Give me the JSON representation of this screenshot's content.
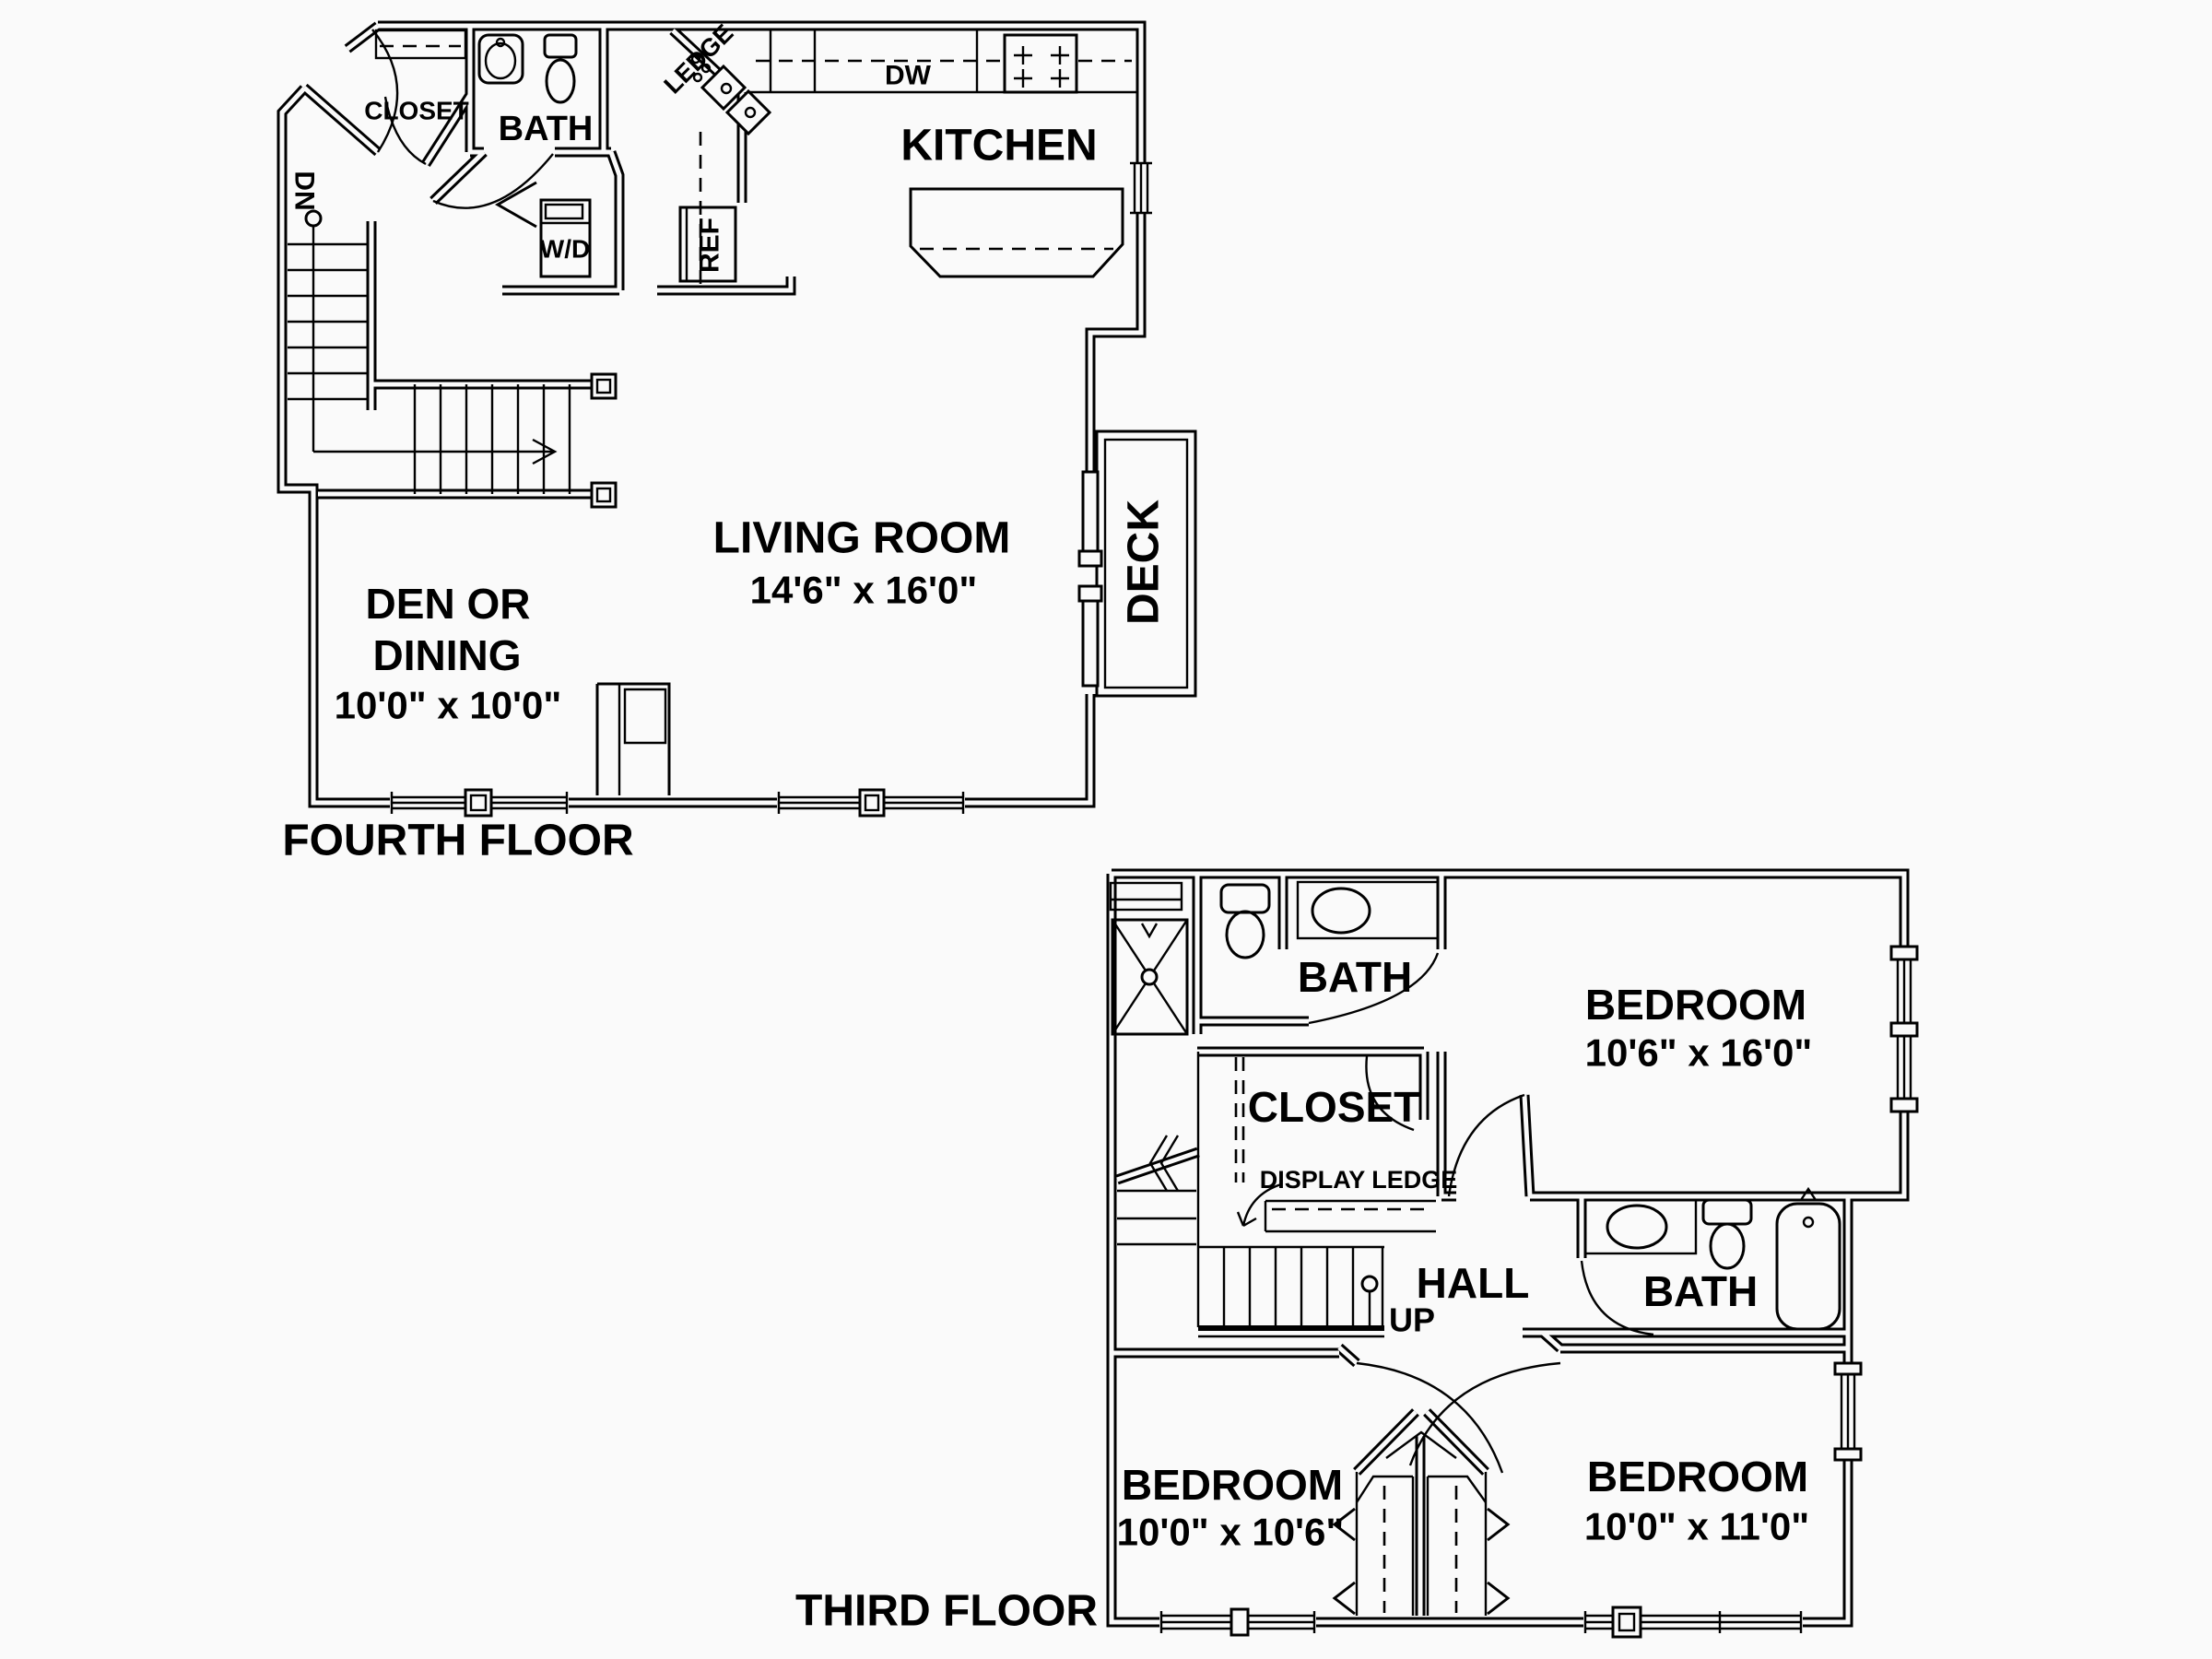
{
  "document": {
    "type": "architectural floor plan, two stacked unit levels, black line work on white paper"
  },
  "colors": {
    "line": "#000000",
    "paper": "#fafafa"
  },
  "floors": [
    {
      "title": "FOURTH FLOOR",
      "labels": {
        "closet": "CLOSET",
        "bath": "BATH",
        "dn": "DN",
        "wd": "W/D",
        "ledge": "LEDGE",
        "dw": "DW",
        "ref": "REF",
        "kitchen": "KITCHEN",
        "living_name": "LIVING ROOM",
        "living_dims": "14'6\" x 16'0\"",
        "den_line1": "DEN OR",
        "den_line2": "DINING",
        "den_dims": "10'0\" x 10'0\"",
        "deck": "DECK"
      }
    },
    {
      "title": "THIRD FLOOR",
      "labels": {
        "bath_upper": "BATH",
        "bedroom1_name": "BEDROOM",
        "bedroom1_dims": "10'6\" x 16'0\"",
        "closet": "CLOSET",
        "display_ledge": "DISPLAY LEDGE",
        "hall": "HALL",
        "up": "UP",
        "bath_lower": "BATH",
        "bedroom2_name": "BEDROOM",
        "bedroom2_dims": "10'0\" x 10'6\"",
        "bedroom3_name": "BEDROOM",
        "bedroom3_dims": "10'0\" x 11'0\""
      }
    }
  ]
}
